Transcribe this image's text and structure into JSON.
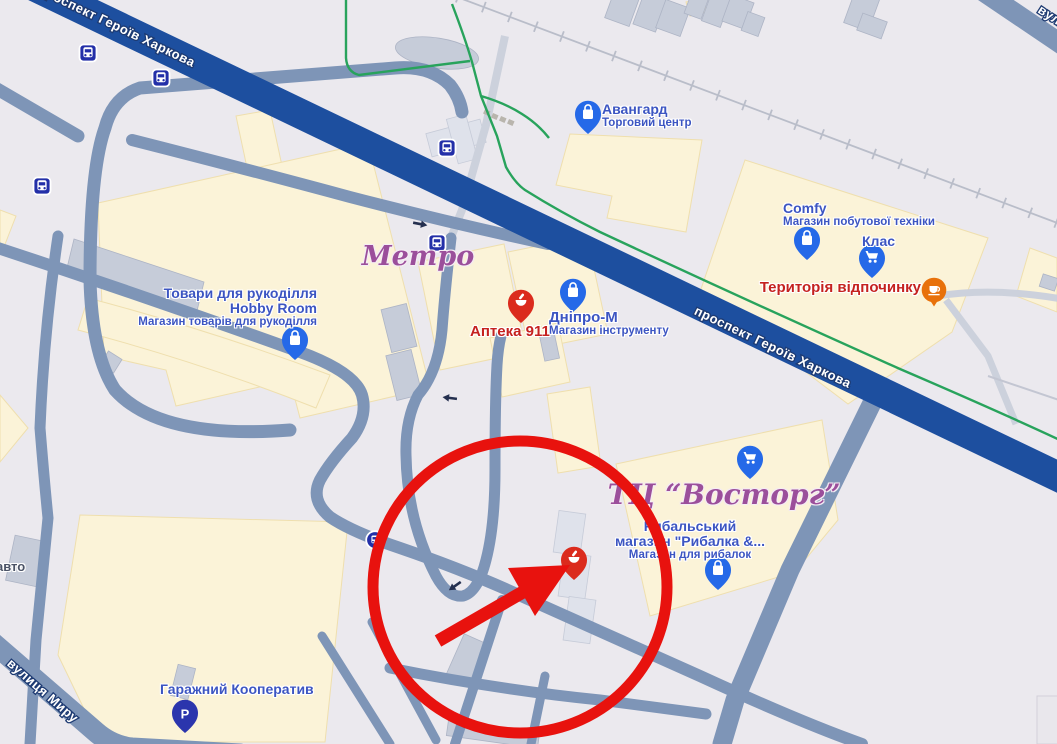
{
  "window": {
    "width": 1057,
    "height": 744
  },
  "roads": {
    "avenue_label": "проспект Героїв Харкова",
    "avenue_label_2": "проспект Героїв Харкова",
    "myru_label": "вулиця Миру",
    "corner_label": "вулиця"
  },
  "landmarks": {
    "metro": "Метро",
    "vostorg": "ТЦ “Восторг”"
  },
  "pois": {
    "avangard": {
      "title": "Авангард",
      "subtitle": "Торговий центр"
    },
    "comfy": {
      "title": "Comfy",
      "subtitle": "Магазин побутової техніки"
    },
    "klas": {
      "title": "Клас"
    },
    "terytoriya": {
      "title": "Територія відпочинку"
    },
    "dnipro": {
      "title": "Дніпро-М",
      "subtitle": "Магазин інструменту"
    },
    "apteka": {
      "title": "Аптека 911"
    },
    "hobby": {
      "title": "Товари для рукоділля",
      "title2": "Hobby Room",
      "subtitle": "Магазин товарів для рукоділля"
    },
    "rybalka": {
      "title": "Рибальський",
      "title2": "магазин \"Рибалка &...",
      "subtitle": "Магазин для рибалок"
    },
    "garage": {
      "title": "Гаражний Кооператив"
    },
    "avto": {
      "title": "авто"
    },
    "parking_glyph": "P"
  },
  "colors": {
    "bg": "#ebe9ee",
    "area_cream": "#fbf3d8",
    "building_gray": "#c6ccd9",
    "road_steel": "#7e95b7",
    "road_avenue": "#1d4f9f",
    "road_light": "#ccd1dc",
    "path_green": "#28a35c",
    "rail": "#b9bdc9",
    "pin_blue": "#2569e8",
    "pin_red": "#db2b1d",
    "pin_parking": "#2b35ad",
    "cafe_orange": "#e8710a",
    "label_blue": "#3c55c2",
    "label_red": "#c5221f",
    "landmark_purple": "#9b4f9b",
    "annotation_red": "#e8120e",
    "bus_navy": "#232fa8"
  }
}
